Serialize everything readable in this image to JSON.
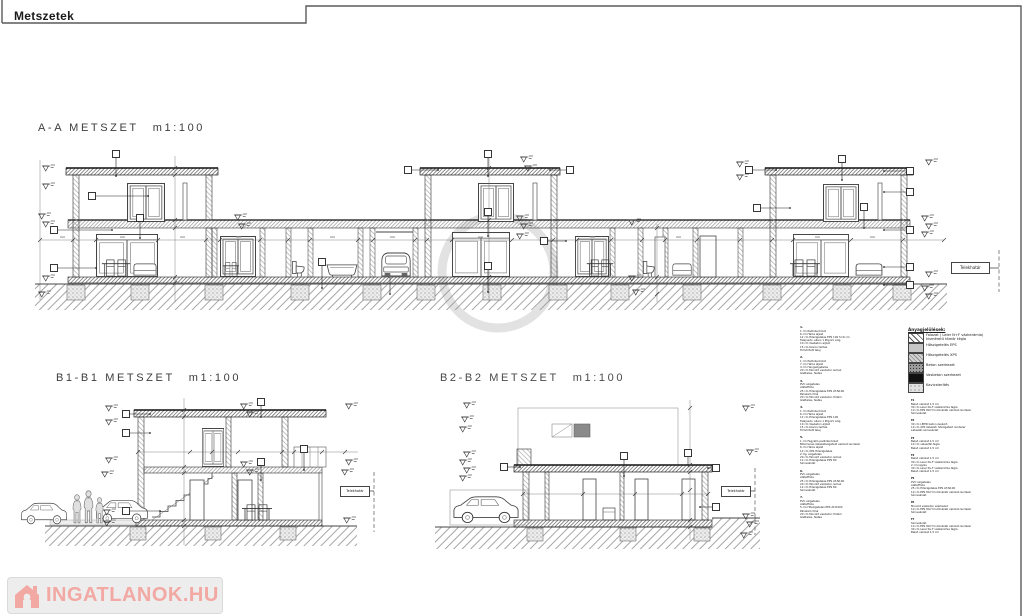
{
  "page": {
    "tab_title": "Metszetek"
  },
  "sections": {
    "a": {
      "name": "A-A METSZET",
      "scale": "m1:100"
    },
    "b1": {
      "name": "B1-B1 METSZET",
      "scale": "m1:100"
    },
    "b2": {
      "name": "B2-B2 METSZET",
      "scale": "m1:100"
    }
  },
  "boundary_label": "Telekhatár",
  "legend": {
    "title": "Anyagjelölések:",
    "items": [
      {
        "lines": [
          "Falazat ( Leier N+F vázkerámia)",
          "kisméretű tömör tégla"
        ],
        "pattern": "brick-hatch"
      },
      {
        "lines": [
          "Hőszigetelés EPS"
        ],
        "pattern": "eps"
      },
      {
        "lines": [
          "Hőszigetelés XPS"
        ],
        "pattern": "xps"
      },
      {
        "lines": [
          "Beton szerkezet"
        ],
        "pattern": "concrete"
      },
      {
        "lines": [
          "Vasbeton szerkezet"
        ],
        "pattern": "rc"
      },
      {
        "lines": [
          "Kavicsterítés"
        ],
        "pattern": "gravel"
      }
    ]
  },
  "notes_col1": [
    {
      "num": "1.",
      "lines": [
        "1 cm Padlóburkolat",
        "6 cm Hálós aljzat",
        "12 cm Hőszigetelés EPS 100 S=6 cm",
        "Talajnedv. elleni 1 Rtg.GV szig.",
        "10 cm Vasbeton aljzat",
        "15 cm Kavics terítés",
        "Tömörített talaj"
      ]
    },
    {
      "num": "2.",
      "lines": [
        "1 cm Padlóburkolat",
        "7 cm Hálós aljzat",
        "4 cm Hangszigetelés",
        "20 cm Monolit vasbeton lemez",
        "Glettelés, festés"
      ]
    },
    {
      "num": "3.",
      "lines": [
        "PVC szigetelés",
        "Alátétfólia",
        "25 cm Hőszigetelés EPS AT-N100",
        "Párazáró fólia",
        "20 cm Monolit vasbeton födém",
        "Glettelés, festés"
      ]
    },
    {
      "num": "4.",
      "lines": [
        "1 cm Padlóburkolat",
        "6 cm Hálós aljzat",
        "12 cm Hőszigetelés EPS 100",
        "Talajnedv. elleni 1 Rtg.GV szig.",
        "10 cm Vasbeton aljzat",
        "15 cm Kavics terítés",
        "Tömörített talaj"
      ]
    },
    {
      "num": "5.",
      "lines": [
        "1 cm Fagyálló padlóburkolat",
        "Bitumenes lábazatszigetelő vakolat rendszer",
        "6 cm Hálós aljzat",
        "12 cm XPS Hőszigetelés",
        "2 rtg. szigetelés",
        "20 cm Monolit vasbeton lemez",
        "12 cm Hőszigetelés EPS 80",
        "Színvakolat"
      ]
    },
    {
      "num": "6.",
      "lines": [
        "PVC szigetelés",
        "Alátétfólia",
        "25 cm Hőszigetelés EPS AT-N100",
        "20 cm Monolit vasbeton lemez",
        "12 cm Hőszigetelés EPS 80",
        "Színvakolat"
      ]
    },
    {
      "num": "7.",
      "lines": [
        "PVC szigetelés",
        "Alátétfólia",
        "5 cm Hőszigetelés EPS AT-N100",
        "Párazáró fólia",
        "20 cm Monolit vasbeton födém",
        "Glettelés, festés"
      ]
    }
  ],
  "notes_col2": [
    {
      "num": "f1",
      "lines": [
        "Belső vakolat 1,5 cm",
        "30 cm Leier N+F vázkerámia tégla",
        "10 cm EPS 80-H homlokzati vakolat rendszer",
        "Színvakolat"
      ]
    },
    {
      "num": "f2",
      "lines": [
        "30 cm LEIER beton zsalukő",
        "10 cm XPS lábazati hőszigetelő rendszer",
        "Lábazati színvakolat"
      ]
    },
    {
      "num": "f3",
      "lines": [
        "Belső vakolat 1,5 cm",
        "10 cm válaszfal tégla",
        "Belső vakolat 1,5 cm"
      ]
    },
    {
      "num": "f4",
      "lines": [
        "Belső vakolat 1,5 cm",
        "30 cm Leier N+F vázkerámia tégla",
        "2 cm légrés",
        "30 cm Leier N+F vázkerámia tégla",
        "Belső vakolat 1,5 cm"
      ]
    },
    {
      "num": "f5",
      "lines": [
        "PVC szigetelés",
        "Alátétfólia",
        "25 cm Hőszigetelés EPS AT-N100",
        "10 cm EPS 80-H homlokzati vakolat rendszer",
        "Színvakolat"
      ]
    },
    {
      "num": "f6",
      "lines": [
        "Monolit vasbeton szerkezet",
        "10 cm EPS 80-H homlokzati vakolat rendszer",
        "Színvakolat"
      ]
    },
    {
      "num": "f7",
      "lines": [
        "Színvakolat",
        "10 cm EPS 80-H homlokzati vakolat rendszer",
        "30 cm Leier N+F vázkerámia tégla",
        "Belső vakolat 1,5 cm"
      ]
    }
  ],
  "watermark": {
    "logo_text": "INGATLANOK.HU",
    "drawing_mark": "VI"
  },
  "colors": {
    "logo_pink": "#f2a49f",
    "line_dark": "#333333",
    "hatch_gray": "#9a9a9a"
  }
}
